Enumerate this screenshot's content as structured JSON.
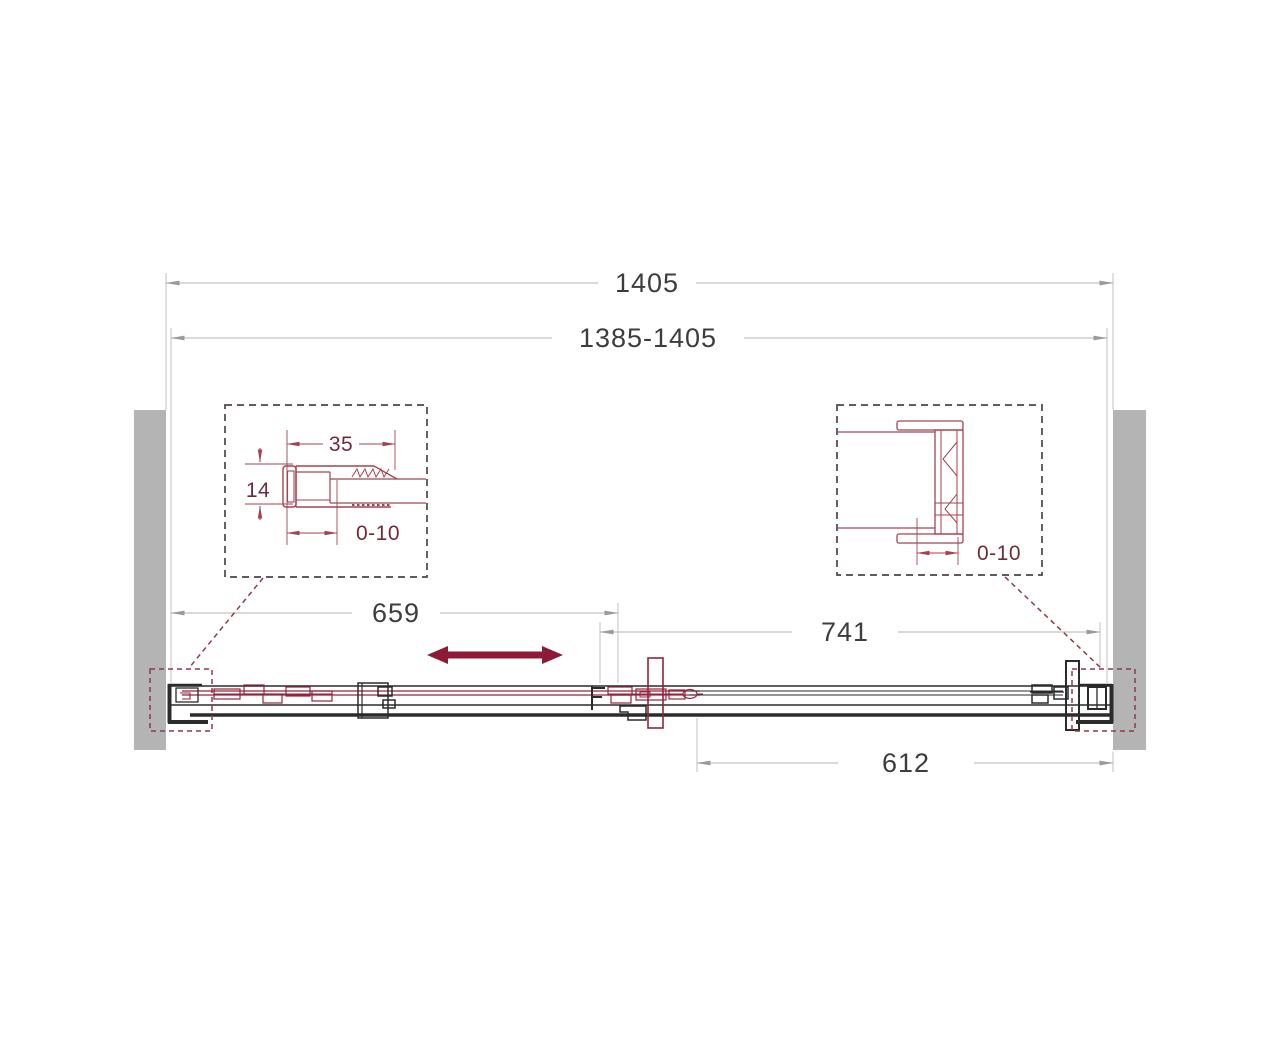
{
  "drawing": {
    "kind": "sliding-shower-door-technical-drawing",
    "dimensions": {
      "overall": "1405",
      "adjust_range": "1385-1405",
      "sliding_panel": "659",
      "right_section": "741",
      "fixed_glass": "612"
    },
    "left_detail": {
      "profile_width": "35",
      "profile_depth": "14",
      "adjust": "0-10"
    },
    "right_detail": {
      "adjust": "0-10"
    }
  },
  "colors": {
    "background": "#ffffff",
    "wall": "#b4b4b4",
    "line_black": "#2b2b2b",
    "maroon": "#93243c",
    "maroon_soft": "#a34352",
    "dim_line": "#c2c2c2",
    "arrow_gray": "#9a9a9a",
    "text_dark": "#3d3d3d",
    "text_detail": "#6e2b3a",
    "callout": "#8e3a48",
    "detail_border": "#4f4444",
    "slide_arrow": "#8e1b35"
  }
}
